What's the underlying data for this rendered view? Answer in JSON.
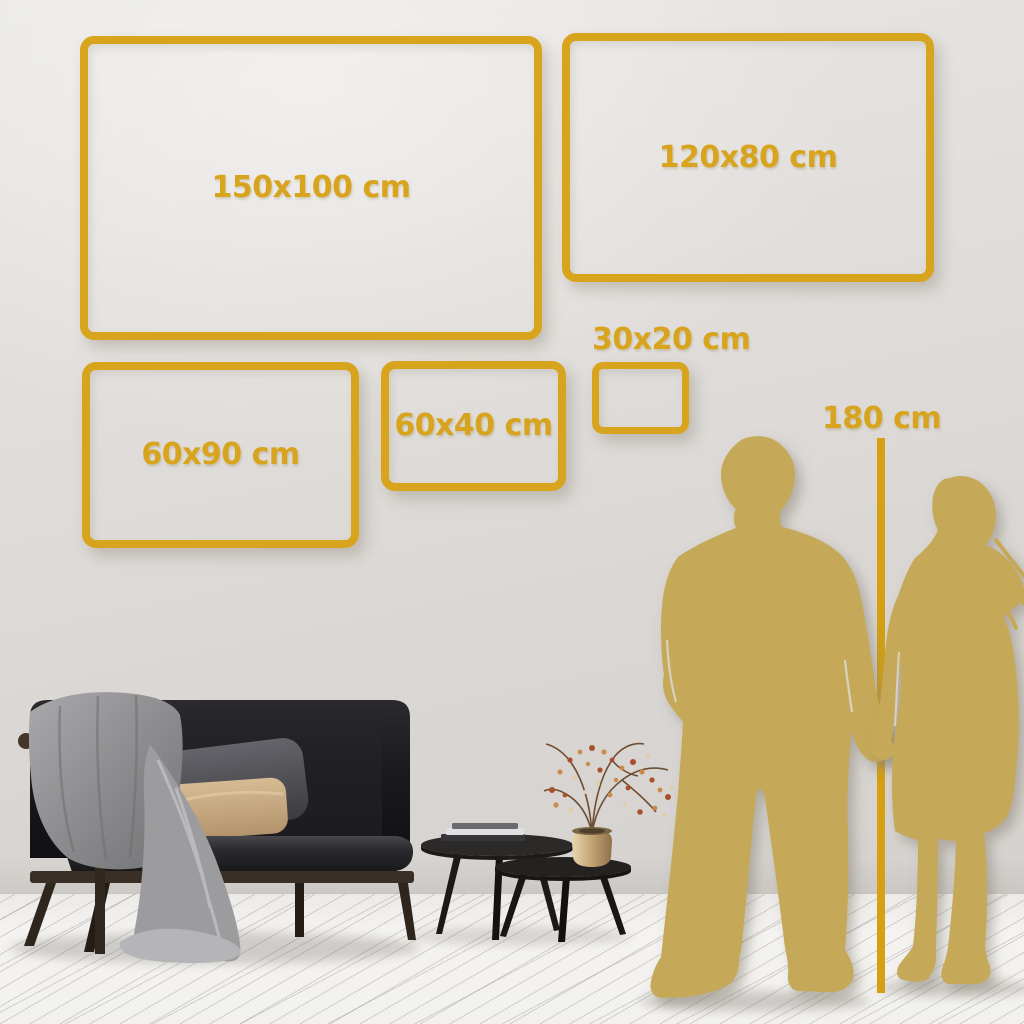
{
  "scene": {
    "description_labels": [],
    "colors": {
      "accent_gold": "#d8a41e",
      "line_gold": "#d5a011",
      "silhouette_gold": "#c5a958",
      "wall": "#dedbd8",
      "floor": "#f2f1ee"
    }
  },
  "size_frames": [
    {
      "id": "150x100",
      "label": "150x100 cm",
      "width_cm": 150,
      "height_cm": 100
    },
    {
      "id": "120x80",
      "label": "120x80 cm",
      "width_cm": 120,
      "height_cm": 80
    },
    {
      "id": "60x90",
      "label": "60x90 cm",
      "width_cm": 60,
      "height_cm": 90
    },
    {
      "id": "60x40",
      "label": "60x40 cm",
      "width_cm": 60,
      "height_cm": 40
    },
    {
      "id": "30x20",
      "label": "30x20 cm",
      "width_cm": 30,
      "height_cm": 20
    }
  ],
  "height_marker": {
    "label": "180 cm",
    "value_cm": 180
  },
  "figures": [
    {
      "name": "man-silhouette"
    },
    {
      "name": "woman-silhouette"
    }
  ],
  "furniture": [
    {
      "name": "sofa"
    },
    {
      "name": "throw-blanket"
    },
    {
      "name": "gray-pillow"
    },
    {
      "name": "tan-pillow"
    },
    {
      "name": "coffee-table-large"
    },
    {
      "name": "coffee-table-small"
    },
    {
      "name": "books-stack"
    },
    {
      "name": "brass-vase"
    },
    {
      "name": "dried-plant"
    }
  ]
}
